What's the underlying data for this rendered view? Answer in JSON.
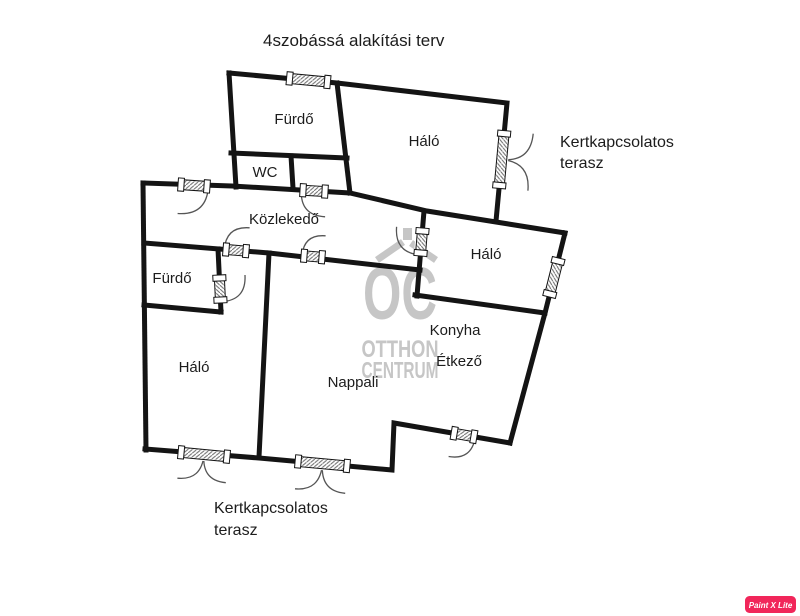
{
  "title": "4szobássá alakítási terv",
  "rooms": {
    "furdo_top": "Fürdő",
    "wc": "WC",
    "halo_top_right": "Háló",
    "kozlekedo": "Közlekedő",
    "furdo_left": "Fürdő",
    "halo_middle": "Háló",
    "halo_bottom": "Háló",
    "nappali": "Nappali",
    "konyha": "Konyha",
    "etkezo": "Étkező"
  },
  "terrace_right": {
    "line1": "Kertkapcsolatos",
    "line2": "terasz"
  },
  "terrace_bottom": {
    "line1": "Kertkapcsolatos",
    "line2": "terasz"
  },
  "watermark": {
    "monogram": "OC",
    "name_line1": "OTTHON",
    "name_line2": "CENTRUM"
  },
  "badge": {
    "label": "Paint X Lite",
    "color": "#f1265a"
  },
  "colors": {
    "wall": "#141414",
    "label_text": "#1c1c1c",
    "watermark": "#c6c6c6",
    "background": "#ffffff",
    "badge_background": "#f1265a",
    "badge_text": "#ffffff"
  }
}
